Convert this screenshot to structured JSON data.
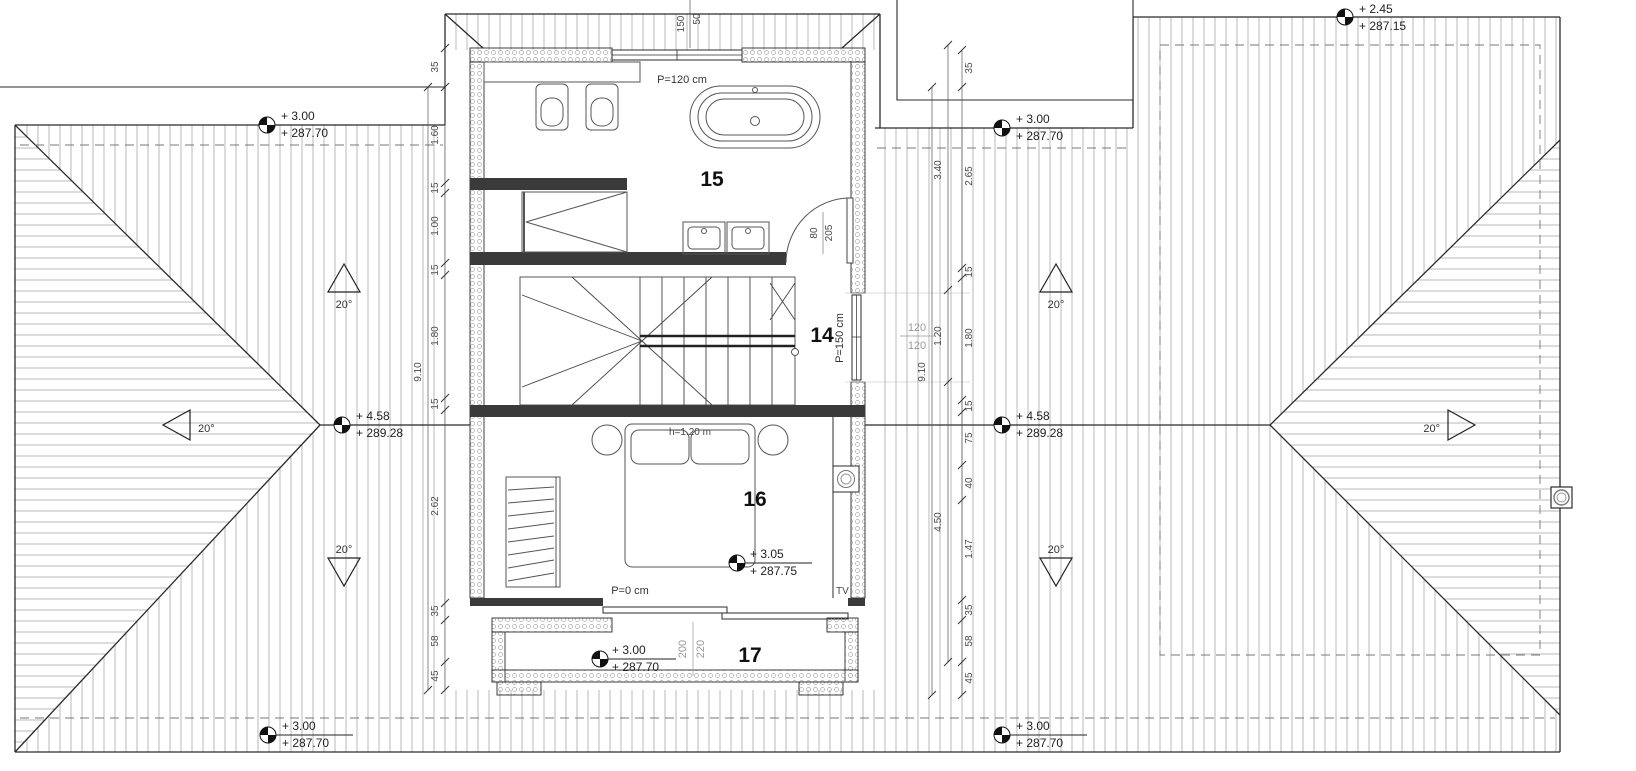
{
  "rooms": {
    "bath": "15",
    "hall": "14",
    "bedroom": "16",
    "terrace": "17"
  },
  "labels": {
    "parapet_bath": "P=120 cm",
    "parapet_hall": "P=150 cm",
    "parapet_terrace": "P=0 cm",
    "bed_height": "h=1.20 m",
    "tv": "TV"
  },
  "levels": {
    "top_left": {
      "rel": "+ 3.00",
      "abs": "+ 287.70"
    },
    "top_right": {
      "rel": "+ 3.00",
      "abs": "+ 287.70"
    },
    "far_top_right": {
      "rel": "+ 2.45",
      "abs": "+ 287.15"
    },
    "ridge_left": {
      "rel": "+ 4.58",
      "abs": "+ 289.28"
    },
    "ridge_right": {
      "rel": "+ 4.58",
      "abs": "+ 289.28"
    },
    "bedroom": {
      "rel": "+ 3.05",
      "abs": "+ 287.75"
    },
    "terrace": {
      "rel": "+ 3.00",
      "abs": "+ 287.70"
    },
    "bottom_left": {
      "rel": "+ 3.00",
      "abs": "+ 287.70"
    },
    "bottom_right": {
      "rel": "+ 3.00",
      "abs": "+ 287.70"
    }
  },
  "slopes": {
    "l_top": "20°",
    "l_side": "20°",
    "l_bottom": "20°",
    "r_top": "20°",
    "r_bottom": "20°",
    "r_side": "20°"
  },
  "dims": {
    "left_chain": [
      "35",
      "1.60",
      "15",
      "1.00",
      "15",
      "1.80",
      "15",
      "2.62",
      "35",
      "58",
      "45"
    ],
    "left_total": "9.10",
    "right_chain": [
      "35",
      "2.65",
      "15",
      "1.80",
      "15",
      "75",
      "40",
      "1.47",
      "35",
      "58",
      "45"
    ],
    "right_outer": [
      "3.40",
      "1.20",
      "4.50"
    ],
    "right_total": "9.10",
    "window_top": {
      "a": "150",
      "b": "50"
    },
    "window_east": {
      "a": "120",
      "b": "120"
    },
    "door_bath": {
      "a": "80",
      "b": "205"
    },
    "terrace_opening": {
      "a": "200",
      "b": "220"
    }
  },
  "colors": {
    "line": "#2b2b2b",
    "hatch": "#9a9a9a",
    "hidden": "#777777",
    "gray_text": "#999999"
  }
}
